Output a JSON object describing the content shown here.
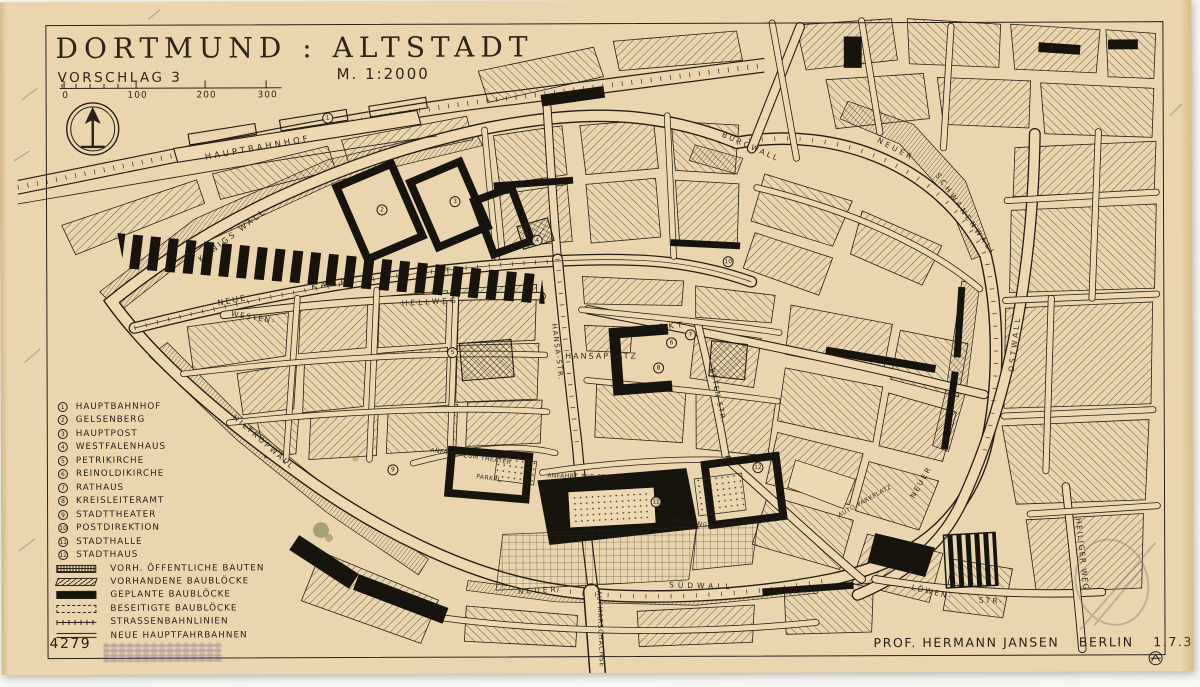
{
  "header": {
    "title": "DORTMUND : ALTSTADT",
    "subtitle": "VORSCHLAG 3",
    "scale_note": "M. 1:2000",
    "scale_ticks": [
      {
        "label": "0",
        "x": 6
      },
      {
        "label": "100",
        "x": 78
      },
      {
        "label": "200",
        "x": 147
      },
      {
        "label": "300",
        "x": 208
      }
    ]
  },
  "legend": {
    "items": [
      {
        "n": "1",
        "label": "HAUPTBAHNHOF"
      },
      {
        "n": "2",
        "label": "GELSENBERG"
      },
      {
        "n": "3",
        "label": "HAUPTPOST"
      },
      {
        "n": "4",
        "label": "WESTFALENHAUS"
      },
      {
        "n": "5",
        "label": "PETRIKIRCHE"
      },
      {
        "n": "6",
        "label": "REINOLDIKIRCHE"
      },
      {
        "n": "7",
        "label": "RATHAUS"
      },
      {
        "n": "8",
        "label": "KREISLEITERAMT"
      },
      {
        "n": "9",
        "label": "STADTTHEATER"
      },
      {
        "n": "10",
        "label": "POSTDIREKTION"
      },
      {
        "n": "11",
        "label": "STADTHALLE"
      },
      {
        "n": "12",
        "label": "STADTHAUS"
      }
    ],
    "symbols": [
      {
        "symbol": "swatch-public",
        "label": "VORH. ÖFFENTLICHE BAUTEN"
      },
      {
        "symbol": "swatch-existing",
        "label": "VORHANDENE BAUBLÖCKE"
      },
      {
        "symbol": "swatch-planned",
        "label": "GEPLANTE BAUBLÖCKE"
      },
      {
        "symbol": "swatch-removed",
        "label": "BESEITIGTE BAUBLÖCKE"
      },
      {
        "symbol": "swatch-tram",
        "label": "STRASSENBAHNLINIEN"
      },
      {
        "symbol": "swatch-newroad",
        "label": "NEUE HAUPTFAHRBAHNEN"
      }
    ]
  },
  "footer": {
    "sheet_number": "4279",
    "author": "PROF. HERMANN JANSEN",
    "place": "BERLIN",
    "date": "1.7.39"
  },
  "map": {
    "labels": [
      {
        "text": "HAUPTBAHNHOF",
        "x": 258,
        "y": 147,
        "rotate": -10,
        "size": 8.5,
        "ls": 3
      },
      {
        "text": "KÖNIGS WALL",
        "x": 232,
        "y": 234,
        "rotate": -37,
        "size": 8,
        "ls": 2.5
      },
      {
        "text": "NEUE",
        "x": 232,
        "y": 299,
        "rotate": -11,
        "size": 8,
        "ls": 2
      },
      {
        "text": "KAMP",
        "x": 330,
        "y": 283,
        "rotate": -8,
        "size": 8,
        "ls": 4
      },
      {
        "text": "STR.",
        "x": 452,
        "y": 270,
        "rotate": -4,
        "size": 8,
        "ls": 3
      },
      {
        "text": "WESTEN-",
        "x": 253,
        "y": 316,
        "rotate": 10,
        "size": 7.5,
        "ls": 1.5
      },
      {
        "text": "HELLWEG",
        "x": 430,
        "y": 301,
        "rotate": -3,
        "size": 7.5,
        "ls": 3
      },
      {
        "text": "MARKT",
        "x": 662,
        "y": 327,
        "rotate": -6,
        "size": 8,
        "ls": 4
      },
      {
        "text": "HANSAPLATZ",
        "x": 601,
        "y": 356,
        "rotate": 0,
        "size": 8,
        "ls": 2
      },
      {
        "text": "HANSA-STR.",
        "x": 557,
        "y": 352,
        "rotate": 83,
        "size": 7,
        "ls": 1.5
      },
      {
        "text": "BETEN-STR.",
        "x": 717,
        "y": 396,
        "rotate": 78,
        "size": 7,
        "ls": 1.5
      },
      {
        "text": "BURGWALL",
        "x": 751,
        "y": 147,
        "rotate": 24,
        "size": 7.5,
        "ls": 2.5
      },
      {
        "text": "NEUER",
        "x": 896,
        "y": 150,
        "rotate": 28,
        "size": 7.5,
        "ls": 3
      },
      {
        "text": "SCHWANENWALL",
        "x": 966,
        "y": 216,
        "rotate": 55,
        "size": 7.5,
        "ls": 3
      },
      {
        "text": "NEUER",
        "x": 920,
        "y": 483,
        "rotate": -60,
        "size": 7.5,
        "ls": 2
      },
      {
        "text": "OSTWALL",
        "x": 1014,
        "y": 345,
        "rotate": -83,
        "size": 7.5,
        "ls": 3
      },
      {
        "text": "HEILIGER WEG",
        "x": 1081,
        "y": 556,
        "rotate": 84,
        "size": 7.5,
        "ls": 1.5
      },
      {
        "text": "LÖWEN-",
        "x": 931,
        "y": 593,
        "rotate": 13,
        "size": 7.5,
        "ls": 2
      },
      {
        "text": "STR-",
        "x": 990,
        "y": 602,
        "rotate": 4,
        "size": 7.5,
        "ls": 2
      },
      {
        "text": "NEUER",
        "x": 537,
        "y": 590,
        "rotate": -3,
        "size": 7.5,
        "ls": 3
      },
      {
        "text": "SÜDWALL",
        "x": 700,
        "y": 586,
        "rotate": 2,
        "size": 7.5,
        "ls": 4
      },
      {
        "text": "AUFMARSCHACHSE",
        "x": 599,
        "y": 629,
        "rotate": 88,
        "size": 6.5,
        "ls": 1
      },
      {
        "text": "HILTROPWALL",
        "x": 263,
        "y": 441,
        "rotate": 41,
        "size": 7.5,
        "ls": 2.5
      },
      {
        "text": "ANFAHRT ZUM THEATER",
        "x": 470,
        "y": 456,
        "rotate": 9,
        "size": 6,
        "ls": 0.5
      },
      {
        "text": "PARKPL.",
        "x": 489,
        "y": 478,
        "rotate": 8,
        "size": 6,
        "ls": 0.5
      },
      {
        "text": "ANFAHRT ZUR STADTHALLE",
        "x": 593,
        "y": 477,
        "rotate": 2,
        "size": 6,
        "ls": 0.5
      },
      {
        "text": "FUSS-GÄNGER",
        "x": 691,
        "y": 523,
        "rotate": 11,
        "size": 6,
        "ls": 0.5
      },
      {
        "text": "AUTO-PARKPLATZ",
        "x": 864,
        "y": 502,
        "rotate": -29,
        "size": 6,
        "ls": 0.5
      }
    ],
    "markers": [
      {
        "n": "1",
        "x": 328,
        "y": 117
      },
      {
        "n": "2",
        "x": 382,
        "y": 209
      },
      {
        "n": "3",
        "x": 455,
        "y": 201
      },
      {
        "n": "4",
        "x": 537,
        "y": 240
      },
      {
        "n": "5",
        "x": 452,
        "y": 352
      },
      {
        "n": "6",
        "x": 671,
        "y": 343
      },
      {
        "n": "7",
        "x": 690,
        "y": 335
      },
      {
        "n": "8",
        "x": 658,
        "y": 368
      },
      {
        "n": "9",
        "x": 392,
        "y": 469
      },
      {
        "n": "10",
        "x": 728,
        "y": 262
      },
      {
        "n": "11",
        "x": 655,
        "y": 502
      },
      {
        "n": "12",
        "x": 757,
        "y": 468
      }
    ]
  },
  "colors": {
    "paper": "#e9d6ae",
    "ink": "#26221a",
    "backdrop": "#f7f7f5",
    "stamp_purple": "#5a4a8c",
    "stain_green": "#6b7a3a"
  }
}
